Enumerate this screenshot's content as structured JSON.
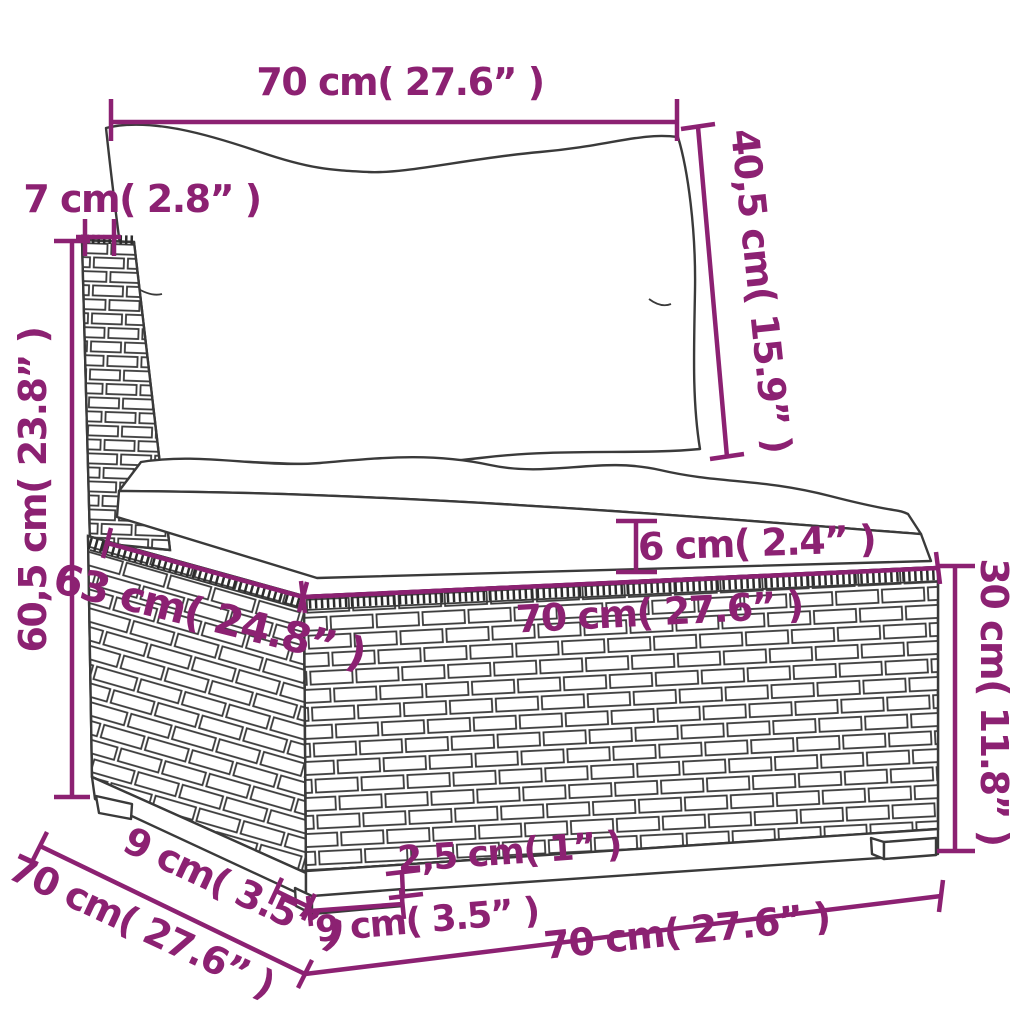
{
  "diagram_title": "garden sofa middle section dimension drawing",
  "colors": {
    "dimension_accent": "#8c2172",
    "line_art": "#3a3a3a",
    "background": "#ffffff"
  },
  "dimensions": {
    "back_cushion_width": "70 cm( 27.6” )",
    "post_width": "7 cm( 2.8” )",
    "back_cushion_height": "40,5 cm( 15.9” )",
    "total_height": "60,5 cm( 23.8” )",
    "seat_cushion_thickness": "6 cm( 2.4” )",
    "seat_depth_top": "63 cm( 24.8” )",
    "seat_width": "70 cm( 27.6” )",
    "base_height": "30 cm( 11.8” )",
    "plinth_clearance": "2,5 cm( 1” )",
    "foot_width": "9 cm( 3.5” )",
    "foot_depth": "9 cm( 3.5” )",
    "base_depth": "70 cm( 27.6” )",
    "base_width_bottom": "70 cm( 27.6” )"
  }
}
